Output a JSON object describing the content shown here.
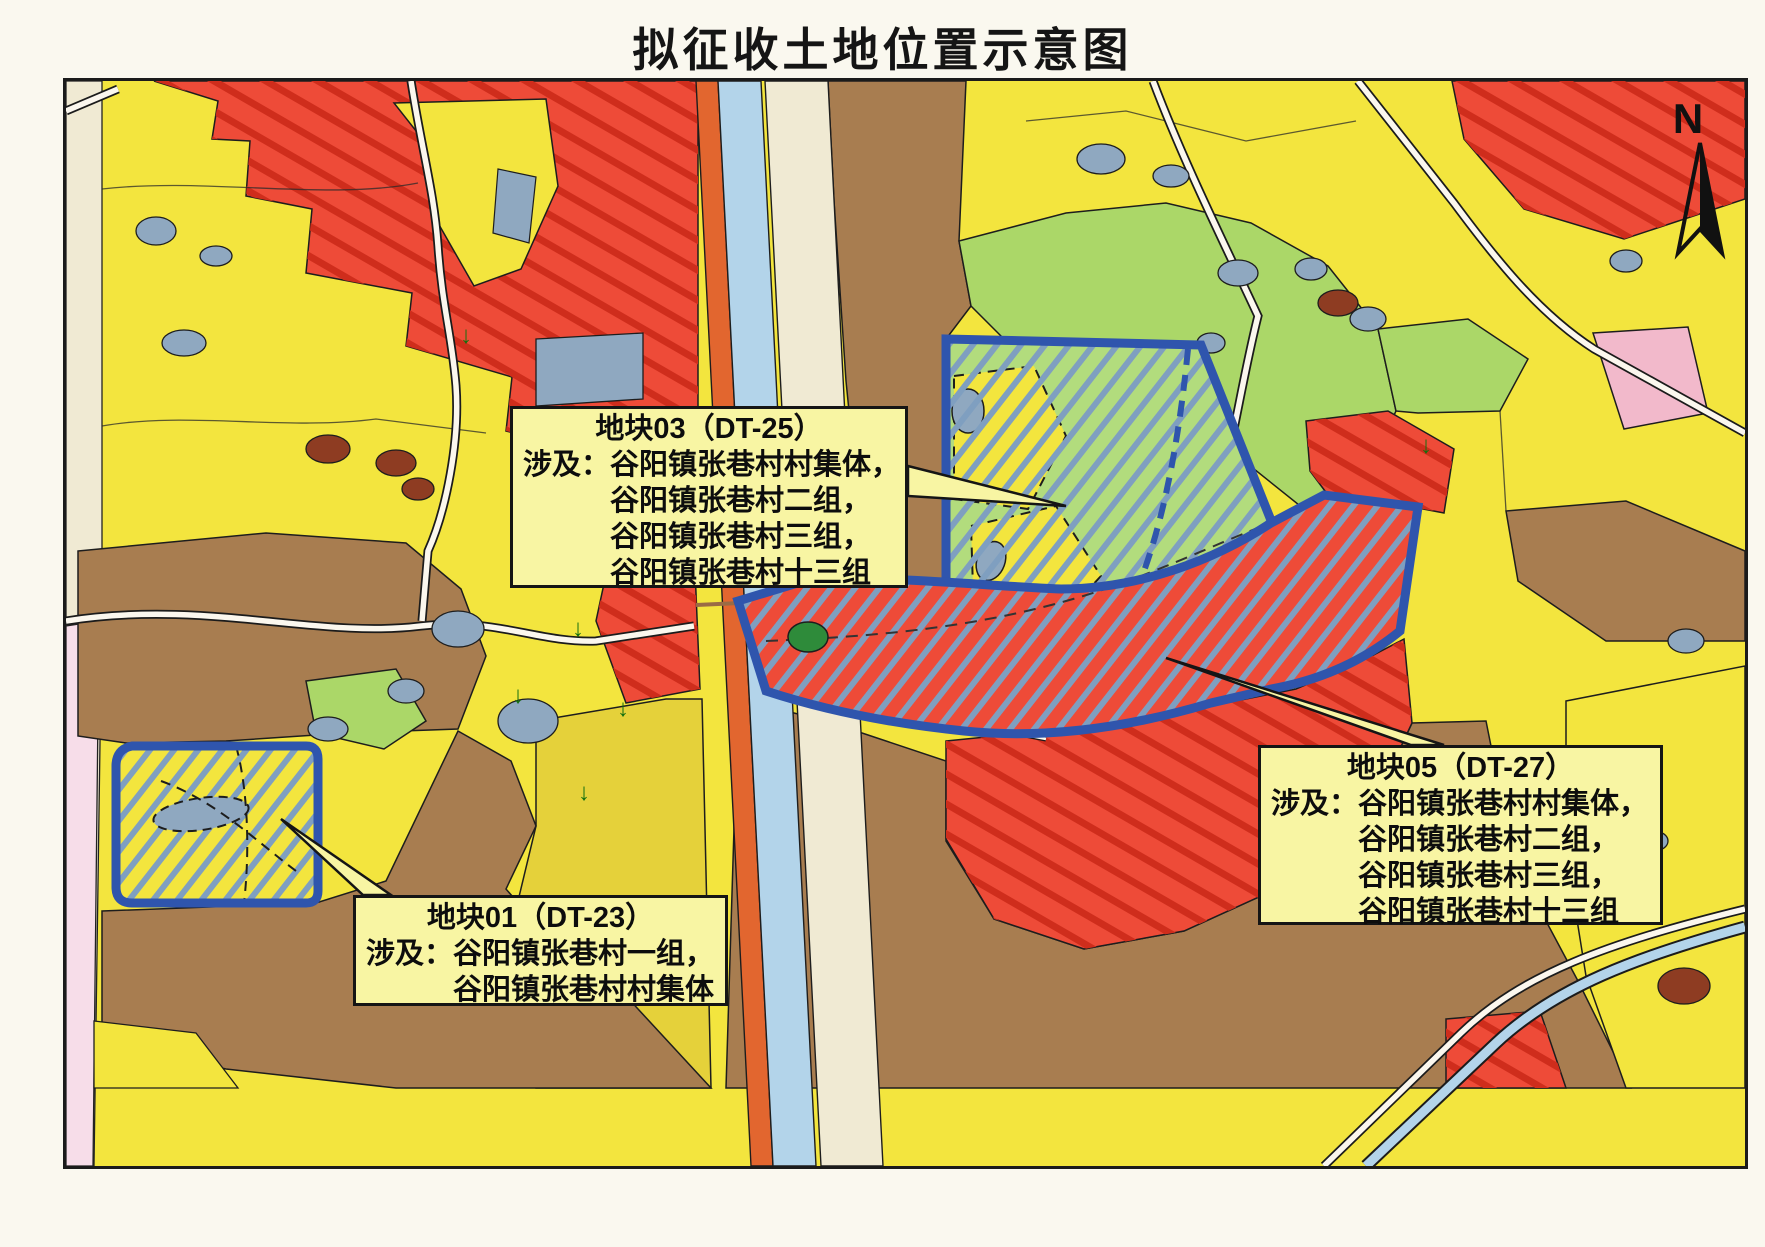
{
  "title": "拟征收土地位置示意图",
  "compass": {
    "label": "N"
  },
  "map": {
    "symbols": {
      "down_arrow": "↓"
    },
    "colors": {
      "yellow_field": "#f3e53e",
      "mustard_field": "#e5d13a",
      "pale_callout_yellow": "#f8f5a3",
      "red_zone": "#ee4b38",
      "red_hatch": "#cf2d1c",
      "brown_field": "#a87d50",
      "green_field": "#abd768",
      "parcel_green": "#b2dc7d",
      "water_blue": "#8fa8c0",
      "canal_blue": "#b3d4ea",
      "road_cream": "#f0ead3",
      "road_orange": "#e2662f",
      "pink_area": "#f2b9cb",
      "pink_strip": "#f7dde9",
      "parcel_border_blue": "#2f55ad",
      "parcel_hatch_blue": "#7f9fc0",
      "maroon_blob": "#8e3c22",
      "dark_green": "#2e8b3a"
    }
  },
  "parcels": {
    "dt23": {
      "label": "地块01（DT-23）"
    },
    "dt25": {
      "label": "地块03（DT-25）"
    },
    "dt27": {
      "label": "地块05（DT-27）"
    }
  },
  "callouts": {
    "dt25": {
      "heading": "地块03（DT-25）",
      "involve_label": "涉及：",
      "lines": [
        "谷阳镇张巷村村集体，",
        "谷阳镇张巷村二组，",
        "谷阳镇张巷村三组，",
        "谷阳镇张巷村十三组"
      ]
    },
    "dt27": {
      "heading": "地块05（DT-27）",
      "involve_label": "涉及：",
      "lines": [
        "谷阳镇张巷村村集体，",
        "谷阳镇张巷村二组，",
        "谷阳镇张巷村三组，",
        "谷阳镇张巷村十三组"
      ]
    },
    "dt23": {
      "heading": "地块01（DT-23）",
      "involve_label": "涉及：",
      "lines": [
        "谷阳镇张巷村一组，",
        "谷阳镇张巷村村集体"
      ]
    }
  }
}
